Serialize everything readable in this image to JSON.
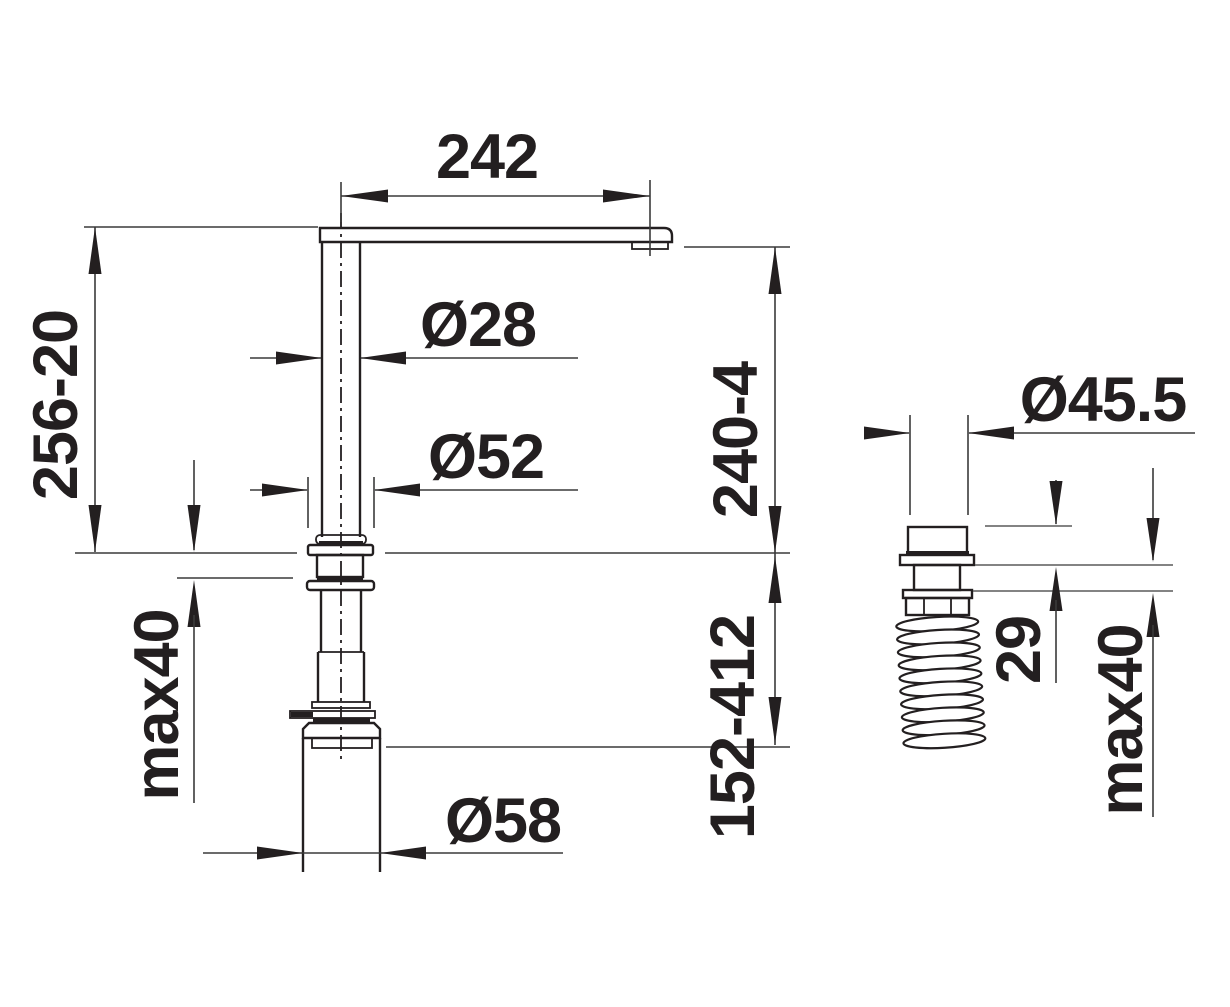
{
  "drawing": {
    "title": "Kitchen faucet installation dimension drawing",
    "views": {
      "main_view": "faucet side elevation with mounting shank through countertop",
      "detail_view": "flexible supply hose fitting with corrugated hose"
    },
    "units": "mm"
  },
  "colors": {
    "line": "#231f20",
    "dim_line": "#3a3a3a",
    "background": "#ffffff"
  },
  "labels": {
    "spout_reach": "242",
    "spout_height_range": "256-20",
    "riser_diameter": "Ø28",
    "escutcheon_diameter": "Ø52",
    "outlet_height_range": "240-4",
    "below_counter_range": "152-412",
    "counter_thickness_main": "max40",
    "socket_diameter": "Ø58",
    "fitting_diameter": "Ø45.5",
    "fitting_cap_height": "29",
    "counter_thickness_detail": "max40"
  }
}
